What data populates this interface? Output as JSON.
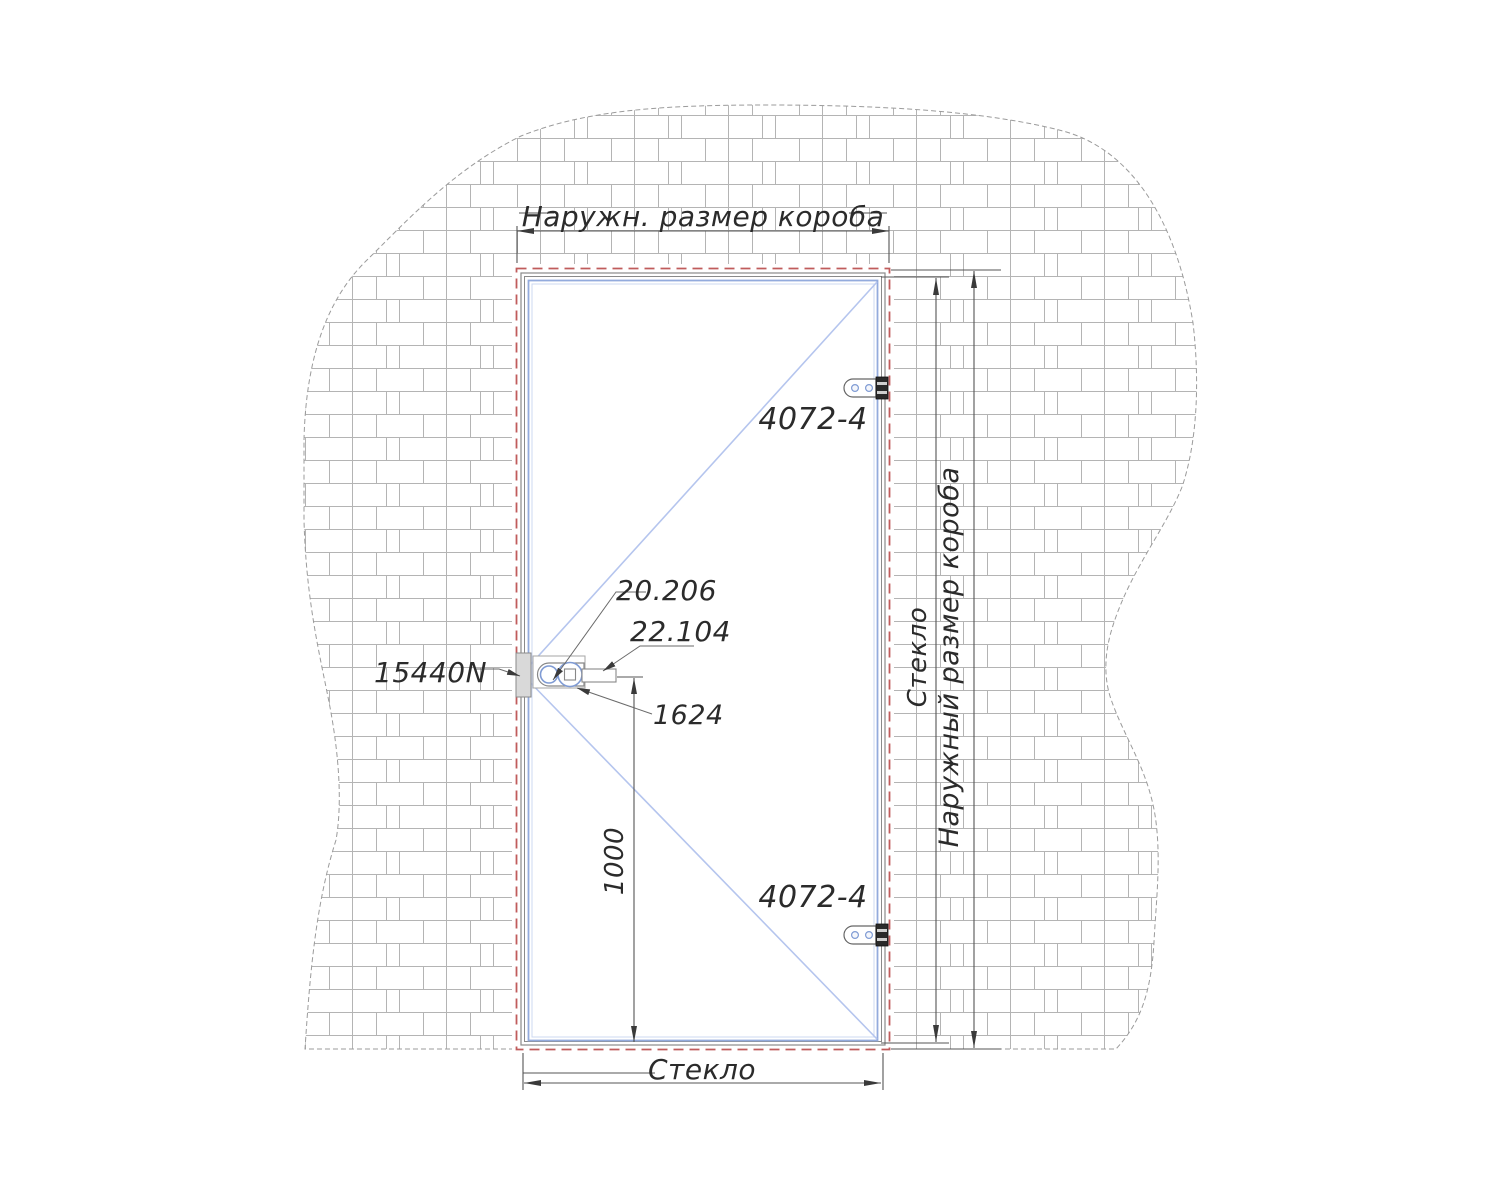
{
  "drawing_type": "door-installation-elevation",
  "dimensions": {
    "outer_width_label": "Наружн. размер короба",
    "glass_width_label": "Стекло",
    "glass_height_label": "Стекло",
    "outer_height_label": "Наружный размер короба",
    "handle_height_value": "1000"
  },
  "hardware": {
    "hinge_top_label": "4072-4",
    "hinge_bottom_label": "4072-4",
    "lock_label": "15440N",
    "cylinder_label": "20.206",
    "handle_label": "22.104",
    "fitting_label": "1624"
  },
  "colors": {
    "opening_dash": "#c05c5c",
    "frame_gray": "#8a8a8a",
    "frame_accent": "#93abdd",
    "frame_accent_light": "#ccd8f2",
    "swing_line": "#b5c5ee",
    "dimension_line": "#555555",
    "leader_line": "#6a6a6a",
    "text": "#2b2b2b",
    "brick_line": "#b4b4b4",
    "wall_outline": "#9b9b9b",
    "hinge_block": "#2a2a2a",
    "screw_blue": "#7f9bd4"
  }
}
